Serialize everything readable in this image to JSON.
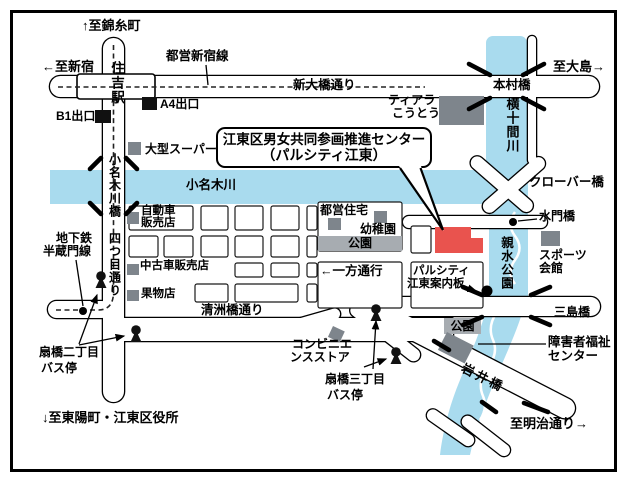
{
  "colors": {
    "river": "#A9DBEE",
    "building_gray": "#7E858C",
    "park_gray": "#A7ACB1",
    "center_red": "#E9534E",
    "line_black": "#000000"
  },
  "callout": {
    "line1": "江東区男女共同参画推進センター",
    "line2": "（パルシティ江東）"
  },
  "labels": {
    "to_kinshicho": "↑至錦糸町",
    "to_shinjuku": "←至新宿",
    "toei_shinjuku_line": "都営新宿線",
    "sumiyoshi_station": "住吉駅",
    "exit_b1": "B1出口",
    "exit_a4": "A4出口",
    "big_super": "大型スーパー",
    "shin_ohashi_dori": "新大橋通り",
    "to_ojima": "至大島→",
    "motomura_bashi": "本村橋",
    "tiara_1": "ティアラ",
    "tiara_2": "こうとう",
    "yokojukken_gawa": "横十間川",
    "onagi_gawa": "小名木川",
    "onagigawa_bashi": "小名木川橋",
    "yotsume_dori": "四つ目通り",
    "jidosha_1": "自動車",
    "jidosha_2": "販売店",
    "toei_jutaku": "都営住宅",
    "yochien": "幼稚園",
    "park_upper": "公園",
    "ippo_tsuko": "←一方通行",
    "chukosha": "中古車販売店",
    "kudamono": "果物店",
    "kiyosubashi_dori": "清洲橋通り",
    "clover_bashi": "クローバー橋",
    "suimon_bashi": "水門橋",
    "shinsui_koen": "親水公園",
    "sports_1": "スポーツ",
    "sports_2": "会館",
    "info_1": "パルシティ",
    "info_2": "江東案内板",
    "mishima_bashi": "三島橋",
    "park_lower": "公園",
    "welfare_1": "障害者福祉",
    "welfare_2": "センター",
    "iwai_bashi": "岩井橋",
    "to_meiji": "至明治通り→",
    "conv_1": "コンビニエ",
    "conv_2": "ンスストア",
    "ogibashi3_1": "扇橋三丁目",
    "ogibashi3_2": "バス停",
    "ogibashi2_1": "扇橋二丁目",
    "ogibashi2_2": "バス停",
    "chikatetsu_1": "地下鉄",
    "chikatetsu_2": "半蔵門線",
    "to_toyocho": "↓至東陽町・江東区役所"
  }
}
